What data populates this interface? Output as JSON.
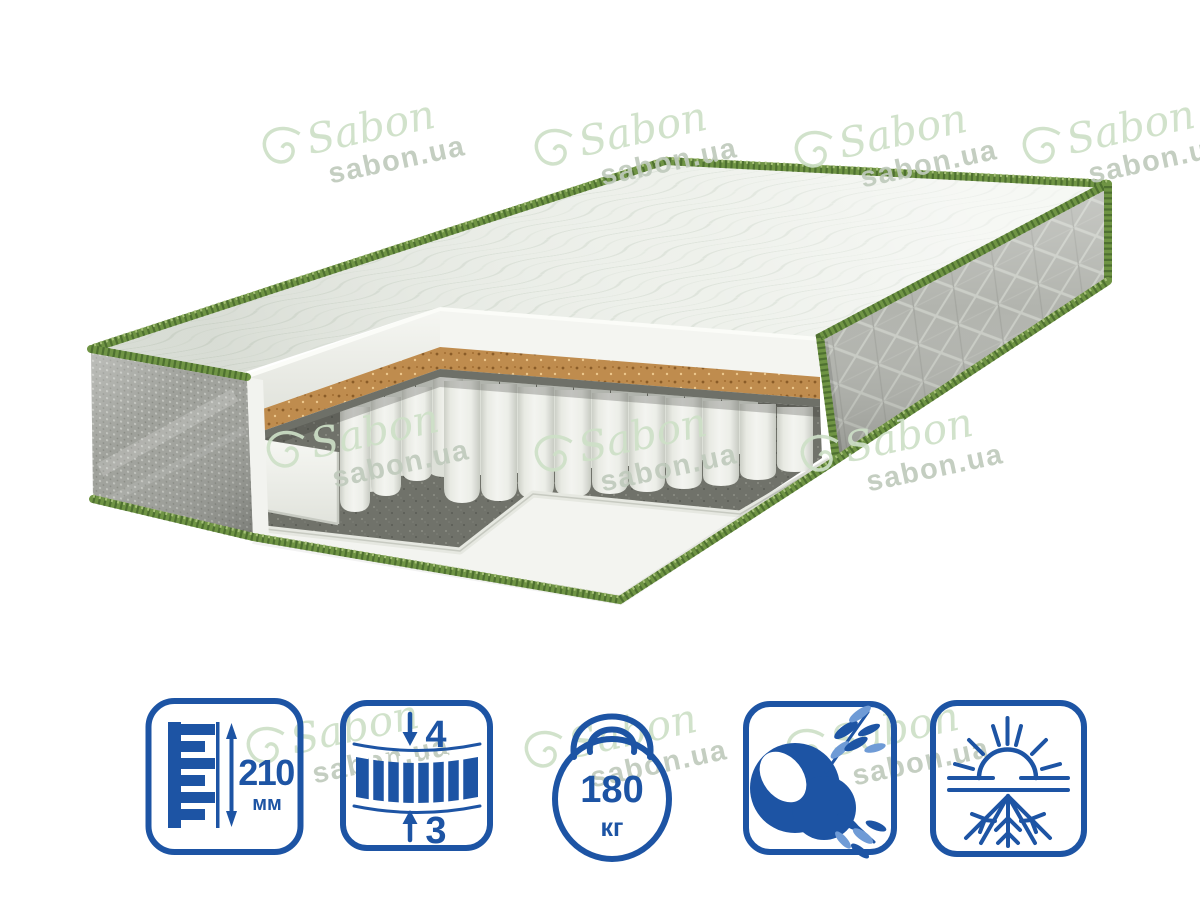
{
  "watermark": {
    "script_text": "Sabon",
    "domain_text": "sabon.ua",
    "script_color": "#cde0c7",
    "domain_color": "#bfcabc"
  },
  "product": {
    "type": "mattress-cutaway-illustration",
    "visible_layers": [
      "quilted-cover",
      "foam-layer",
      "coconut-coir-layer",
      "felt-layer",
      "pocket-springs",
      "felt-base",
      "foam-base"
    ],
    "piping_green": "#6f9444",
    "coir_color": "#bf8a4b"
  },
  "specs": {
    "icon_color": "#1d54a4",
    "height": {
      "icon": "height-ruler-icon",
      "value": "210",
      "unit": "мм"
    },
    "firmness_zones": {
      "icon": "two-sided-spring-block-icon",
      "top_value": "4",
      "bottom_value": "3"
    },
    "max_load": {
      "icon": "kettlebell-icon",
      "value": "180",
      "unit": "кг"
    },
    "features": [
      {
        "icon": "coconut-coir-icon"
      },
      {
        "icon": "summer-winter-icon"
      }
    ]
  }
}
